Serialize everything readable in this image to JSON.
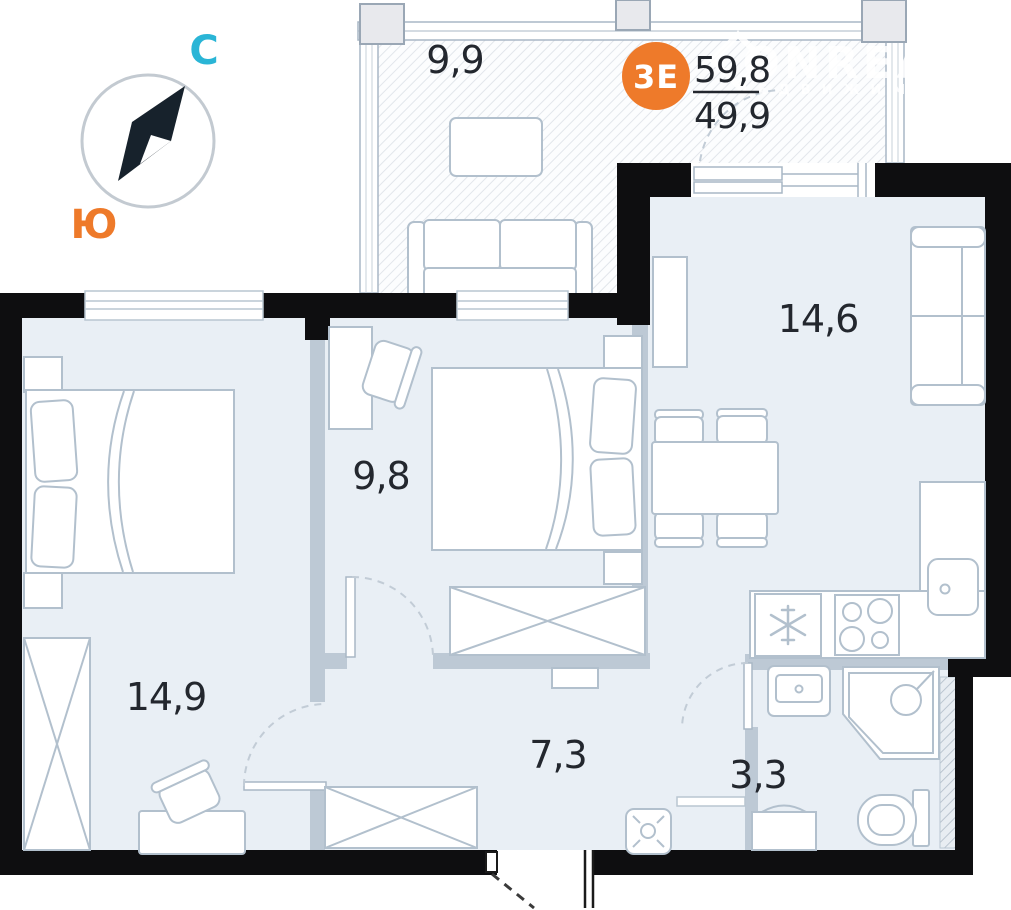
{
  "plan": {
    "type": "apartment-floor-plan",
    "badge": {
      "unit_label": "3Е",
      "total_area": "59,8",
      "living_area": "49,9"
    },
    "compass": {
      "north_label": "С",
      "south_label": "Ю"
    },
    "rooms": [
      {
        "name": "balcony",
        "area": "9,9"
      },
      {
        "name": "kitchen-living-room",
        "area": "14,6"
      },
      {
        "name": "bedroom-middle",
        "area": "9,8"
      },
      {
        "name": "bedroom-left",
        "area": "14,9"
      },
      {
        "name": "hallway",
        "area": "7,3"
      },
      {
        "name": "bathroom",
        "area": "3,3"
      }
    ],
    "watermark": {
      "brand": "ONREALT",
      "tagline": "НЕДВИЖИМОСТЬ"
    },
    "colors": {
      "wall_black": "#0e0e10",
      "floor": "#e9eff5",
      "accent_orange": "#ee7a2a",
      "accent_cyan": "#2ab5d6",
      "furniture_stroke": "#b2c0cd",
      "partition": "#bdc9d5"
    }
  }
}
